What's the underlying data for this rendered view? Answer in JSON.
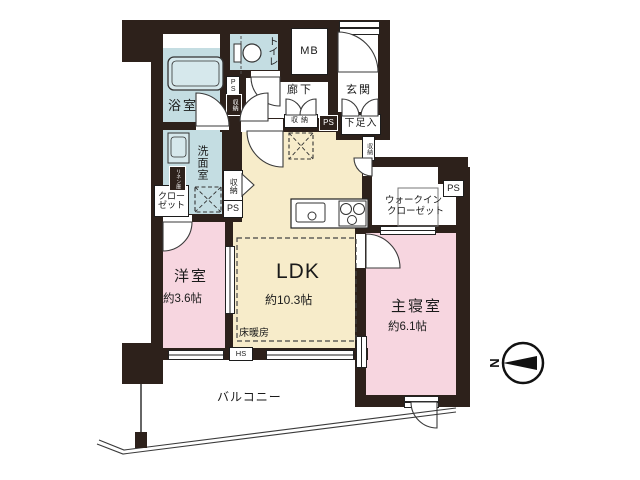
{
  "plan": {
    "rooms": {
      "bath": {
        "label": "浴室"
      },
      "washroom": {
        "label": "洗面室"
      },
      "linen": {
        "label": "リネン庫"
      },
      "closet": {
        "label_line1": "クロー",
        "label_line2": "ゼット"
      },
      "toilet": {
        "label": "トイレ"
      },
      "hallway": {
        "label": "廊下"
      },
      "entrance": {
        "label": "玄関"
      },
      "shoe_box": {
        "label": "下足入"
      },
      "meter_box": {
        "label": "MB"
      },
      "western_room": {
        "label": "洋室",
        "size": "約3.6帖"
      },
      "ldk": {
        "label": "LDK",
        "size": "約10.3帖"
      },
      "floor_heating": {
        "label": "床暖房"
      },
      "master_bedroom": {
        "label": "主寝室",
        "size": "約6.1帖"
      },
      "walk_in_closet": {
        "label_line1": "ウォークイン",
        "label_line2": "クローゼット"
      },
      "balcony": {
        "label": "バルコニー"
      }
    },
    "small_labels": {
      "ps": "PS",
      "storage": "収納",
      "hs": "HS"
    },
    "compass": {
      "north": "N"
    },
    "colors": {
      "wall": "#2d211b",
      "water_rooms": "#c4dde2",
      "ldk": "#f7ecca",
      "bedrooms": "#f7d6e0"
    }
  }
}
